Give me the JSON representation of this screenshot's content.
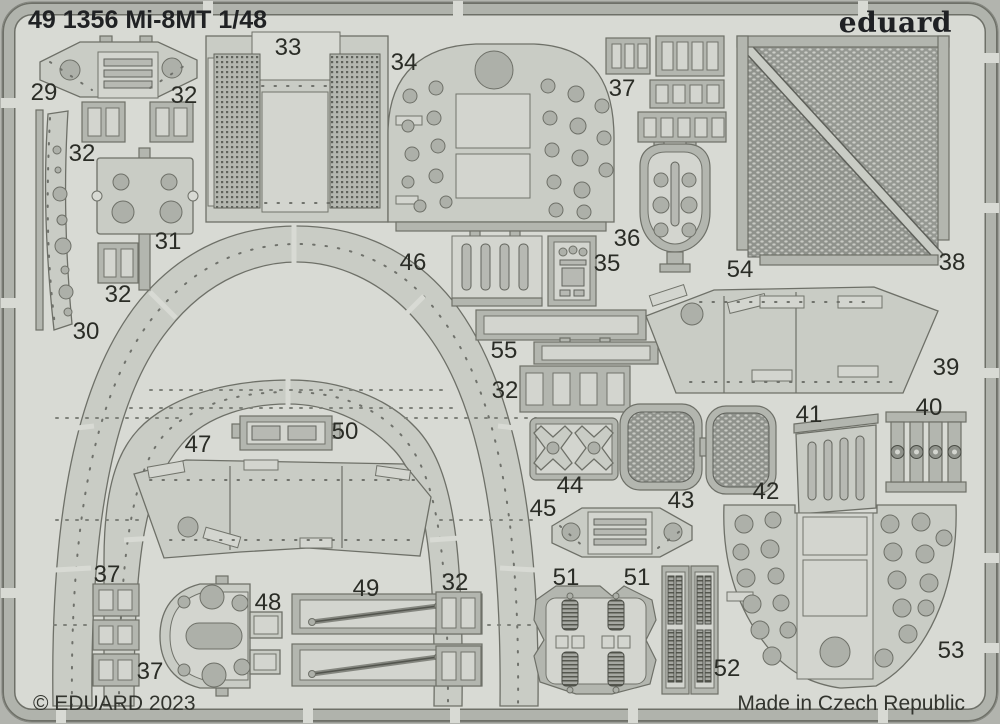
{
  "header": {
    "title": "49 1356  Mi-8MT 1/48",
    "brand": "eduard"
  },
  "footer": {
    "copyright": "© EDUARD 2023",
    "made_in": "Made in Czech Republic"
  },
  "colors": {
    "photo_background": "#b2b4ae",
    "sheet": "#d8dad4",
    "part_surface": "#c9ccc5",
    "carrier_frame": "#b3b6af",
    "etched_hole": "#adb0a9",
    "mesh": "#8f928c",
    "outline": "#6e7068",
    "text": "#2a2c26"
  },
  "parts": [
    {
      "label": "29",
      "x": 44,
      "y": 92
    },
    {
      "label": "32",
      "x": 184,
      "y": 95
    },
    {
      "label": "33",
      "x": 288,
      "y": 47
    },
    {
      "label": "34",
      "x": 404,
      "y": 62
    },
    {
      "label": "37",
      "x": 622,
      "y": 88
    },
    {
      "label": "54",
      "x": 740,
      "y": 269
    },
    {
      "label": "38",
      "x": 952,
      "y": 262
    },
    {
      "label": "32",
      "x": 82,
      "y": 153
    },
    {
      "label": "31",
      "x": 168,
      "y": 241
    },
    {
      "label": "32",
      "x": 118,
      "y": 294
    },
    {
      "label": "30",
      "x": 86,
      "y": 331
    },
    {
      "label": "36",
      "x": 627,
      "y": 238
    },
    {
      "label": "35",
      "x": 607,
      "y": 263
    },
    {
      "label": "46",
      "x": 413,
      "y": 262
    },
    {
      "label": "55",
      "x": 504,
      "y": 350
    },
    {
      "label": "32",
      "x": 505,
      "y": 390
    },
    {
      "label": "39",
      "x": 946,
      "y": 367
    },
    {
      "label": "40",
      "x": 929,
      "y": 407
    },
    {
      "label": "41",
      "x": 809,
      "y": 414
    },
    {
      "label": "47",
      "x": 198,
      "y": 444
    },
    {
      "label": "50",
      "x": 345,
      "y": 431
    },
    {
      "label": "44",
      "x": 570,
      "y": 485
    },
    {
      "label": "43",
      "x": 681,
      "y": 500
    },
    {
      "label": "42",
      "x": 766,
      "y": 491
    },
    {
      "label": "45",
      "x": 543,
      "y": 508
    },
    {
      "label": "37",
      "x": 107,
      "y": 574
    },
    {
      "label": "48",
      "x": 268,
      "y": 602
    },
    {
      "label": "49",
      "x": 366,
      "y": 588
    },
    {
      "label": "32",
      "x": 455,
      "y": 582
    },
    {
      "label": "51",
      "x": 566,
      "y": 577
    },
    {
      "label": "51",
      "x": 637,
      "y": 577
    },
    {
      "label": "52",
      "x": 727,
      "y": 668
    },
    {
      "label": "53",
      "x": 951,
      "y": 650
    },
    {
      "label": "37",
      "x": 150,
      "y": 671
    }
  ]
}
